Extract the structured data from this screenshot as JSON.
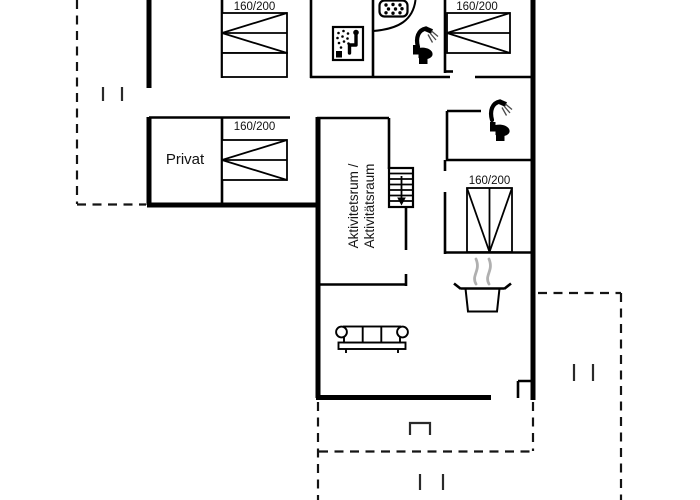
{
  "plan": {
    "background_color": "#ffffff",
    "line_color": "#000000",
    "steam_color": "#b0b0b0",
    "labels": {
      "private_room": "Privat",
      "activity_room_line1": "Aktivitetsrum /",
      "activity_room_line2": "Aktivitätsraum"
    },
    "beds": [
      {
        "id": "bed-top-left",
        "size_label": "160/200"
      },
      {
        "id": "bed-top-right",
        "size_label": "160/200"
      },
      {
        "id": "bed-private-room",
        "size_label": "160/200"
      },
      {
        "id": "bed-middle-right",
        "size_label": "160/200"
      }
    ],
    "icons": [
      "sauna-icon",
      "shower-head-plate-icon",
      "shower-icon",
      "toilet-icon",
      "staircase-down-arrow-icon",
      "cooking-pot-icon",
      "steam-icon",
      "sofa-icon"
    ]
  }
}
